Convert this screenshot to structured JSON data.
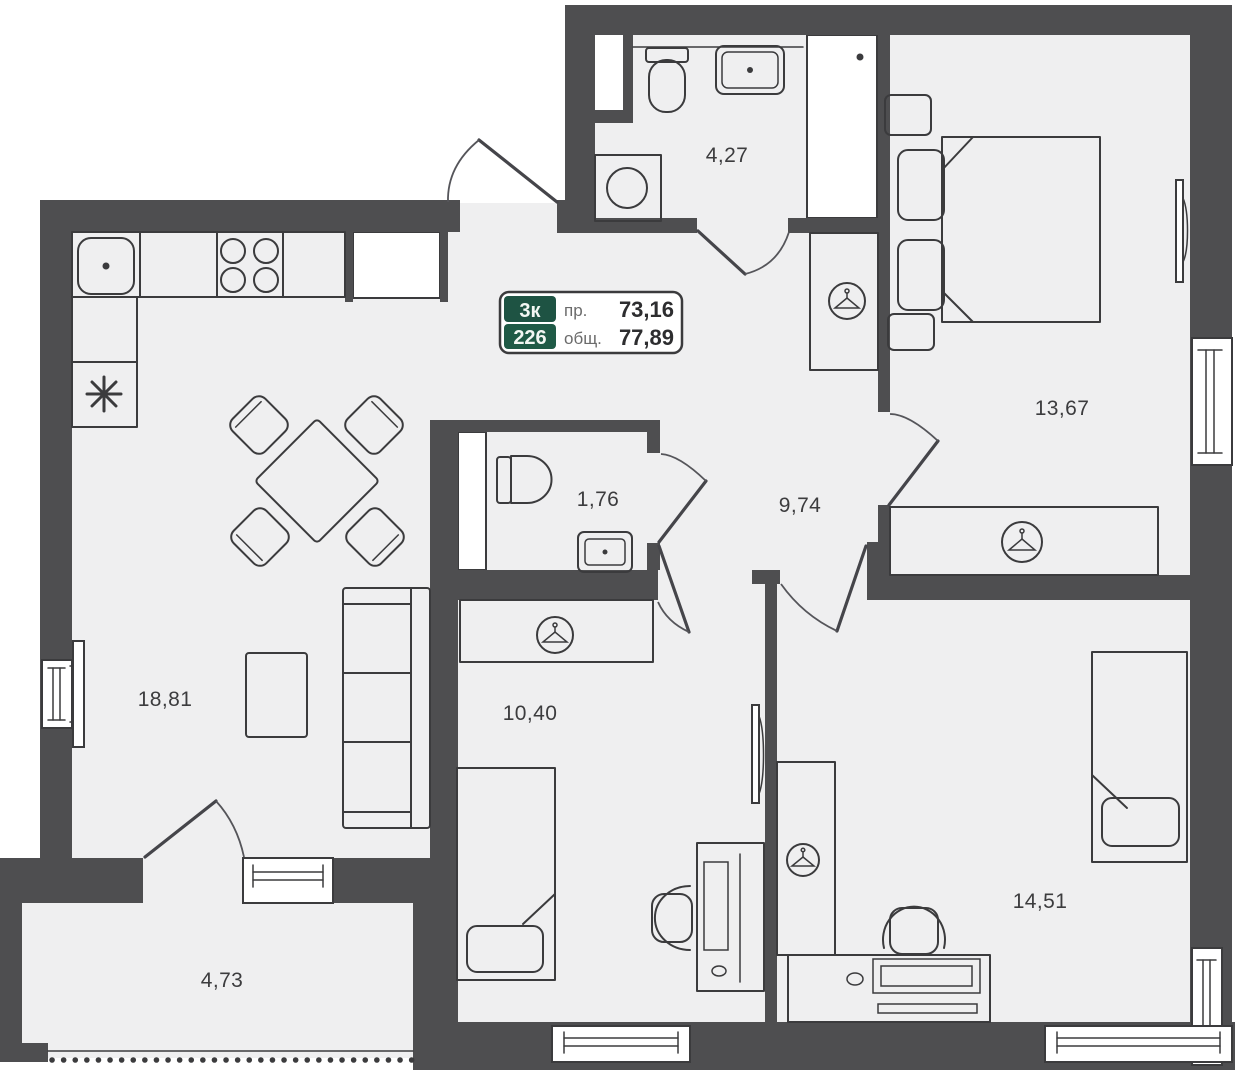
{
  "badge": {
    "rooms_count": "3к",
    "flat_number": "226",
    "living_label": "пр.",
    "living_area": "73,16",
    "total_label": "общ.",
    "total_area": "77,89"
  },
  "room_areas": {
    "bathroom": "4,27",
    "bedroom_main": "13,67",
    "wc": "1,76",
    "hallway": "9,74",
    "kitchen_living": "18,81",
    "bedroom_small": "10,40",
    "bedroom_second": "14,51",
    "balcony": "4,73"
  },
  "colors": {
    "wall": "#4e4e50",
    "floor": "#efeff0",
    "line": "#3b3b3d",
    "badge_green_top": "#1e5343",
    "badge_green_bottom": "#1f5a46",
    "badge_border": "#3b3b3d"
  },
  "icons": {
    "hanger": "wardrobe-hanger-icon",
    "snowflake": "fridge-snowflake-icon"
  }
}
